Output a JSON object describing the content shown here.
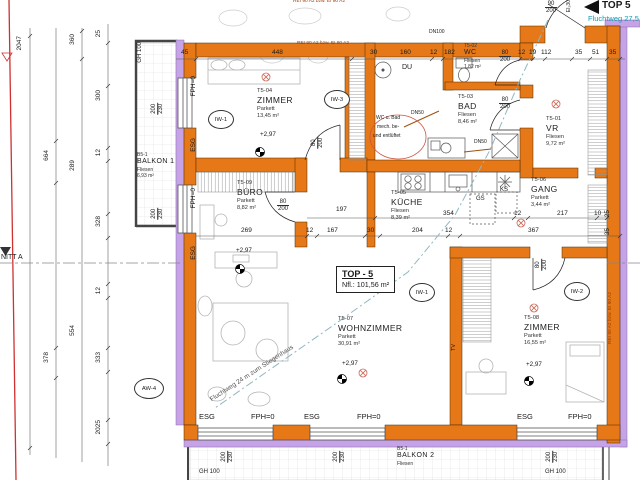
{
  "unit": {
    "name": "TOP - 5",
    "area_label": "Nfl.: 101,56 m²"
  },
  "entry": {
    "label": "TOP 5",
    "escape_top": "Fluchtweg 27,5",
    "fire_rating": "EI₂30"
  },
  "escape_note": "Fluchtweg 24 m zum Stiegenhaus",
  "section_label": "NITT A",
  "fire_wall_note": "REI 90 A2 bzw. EI 90 A2",
  "level": "+2,97",
  "rooms": {
    "zimmer1": {
      "code": "T5-04",
      "name": "ZIMMER",
      "floor": "Parkett",
      "area": "13,45 m²"
    },
    "wc": {
      "code": "T5-02",
      "name": "WC",
      "floor": "Fliesen",
      "area": "1,82 m²"
    },
    "bad": {
      "code": "T5-03",
      "name": "BAD",
      "floor": "Fliesen",
      "area": "8,46 m²"
    },
    "vr": {
      "code": "T5-01",
      "name": "VR",
      "floor": "Fliesen",
      "area": "9,72 m²"
    },
    "gang": {
      "code": "T5-06",
      "name": "GANG",
      "floor": "Parkett",
      "area": "3,44 m²"
    },
    "kueche": {
      "code": "T5-05",
      "name": "KÜCHE",
      "floor": "Fliesen",
      "area": "8,39 m²"
    },
    "buero": {
      "code": "T5-09",
      "name": "BÜRO",
      "floor": "Parkett",
      "area": "8,82 m²"
    },
    "wohnzimmer": {
      "code": "T5-07",
      "name": "WOHNZIMMER",
      "floor": "Parkett",
      "area": "30,91 m²"
    },
    "zimmer2": {
      "code": "T5-08",
      "name": "ZIMMER",
      "floor": "Parkett",
      "area": "16,55 m²"
    },
    "balkon1": {
      "code": "B5-1",
      "name": "BALKON 1",
      "floor": "Fliesen",
      "area": "6,93 m²"
    },
    "balkon2": {
      "code": "B5-1",
      "name": "BALKON 2",
      "floor": "Fliesen"
    }
  },
  "glass_labels": {
    "esg": "ESG",
    "fph": "FPH=0",
    "gh": "GH 100"
  },
  "fixtures": {
    "du": "DU",
    "gs": "GS",
    "ks": "KS",
    "tv": "TV",
    "dn100": "DN100",
    "dn50": "DN50"
  },
  "vent_note": [
    "WC u. Bad",
    "mech. be-",
    "und entlüftet"
  ],
  "wall_tags": {
    "iw1": "IW-1",
    "iw2": "IW-2",
    "iw3": "IW-3",
    "aw4": "AW-4"
  },
  "dims": {
    "top": [
      "45",
      "448",
      "30",
      "160",
      "12",
      "182",
      "12",
      "19",
      "112",
      "35",
      "51",
      "35"
    ],
    "upper_mid": [
      "197",
      "354",
      "12",
      "217",
      "10"
    ],
    "mid": [
      "269",
      "12",
      "167",
      "30",
      "204",
      "12",
      "367"
    ],
    "left_total": "2047",
    "left_a": [
      "664",
      "378"
    ],
    "left_b": [
      "360",
      "289",
      "554"
    ],
    "left_c": [
      "25",
      "300",
      "12",
      "328",
      "12",
      "333",
      "2025"
    ],
    "right": [
      "25",
      "35"
    ],
    "door": {
      "w": "80",
      "h": "200"
    },
    "entry_door": {
      "w": "90",
      "h": "200"
    },
    "window": {
      "w": "200",
      "h": "230"
    }
  }
}
